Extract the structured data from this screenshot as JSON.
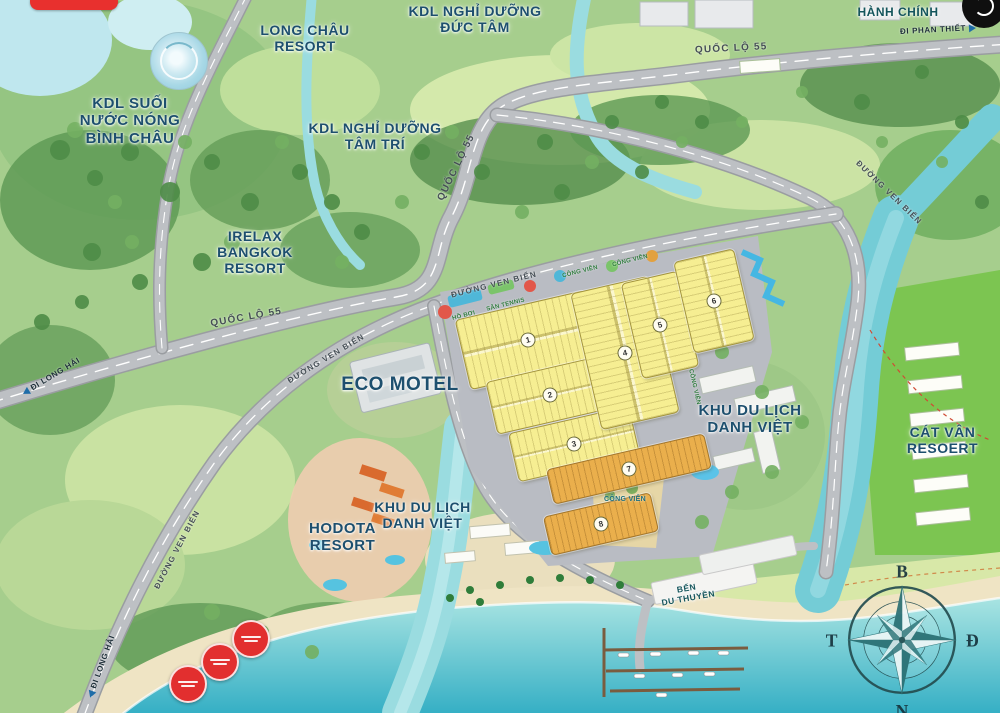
{
  "map": {
    "labels": {
      "binh_chau": "KDL SUỐI\nNƯỚC NÓNG\nBÌNH CHÂU",
      "long_chau": "LONG CHÂU\nRESORT",
      "duc_tam": "KDL NGHỈ DƯỠNG\nĐỨC TÂM",
      "tam_tri": "KDL NGHỈ DƯỠNG\nTÂM TRÍ",
      "irelax": "IRELAX\nBANGKOK\nRESORT",
      "hanh_chinh": "HÀNH CHÍNH",
      "eco_motel": "ECO MOTEL",
      "danh_viet": "KHU DU LỊCH\nDANH VIỆT",
      "cat_van": "CÁT VÂN\nRESOERT",
      "hodota": "HODOTA\nRESORT",
      "ben_du_thuyen": "BẾN\nDU THUYỀN"
    },
    "roads": {
      "quoc_lo_55": "QUỐC LỘ 55",
      "duong_ven_bien": "ĐƯỜNG VEN BIỂN"
    },
    "directions": {
      "di_phan_thiet": "ĐI PHAN THIẾT",
      "di_long_hai": "ĐI LONG HẢI"
    },
    "amenities": {
      "cong_vien": "CÔNG VIÊN",
      "ho_boi": "HỒ BƠI",
      "san_tennis": "SÂN TENNIS"
    },
    "compass": {
      "n": "B",
      "e": "Đ",
      "s": "N",
      "w": "T"
    },
    "blocks": {
      "b1": "1",
      "b2": "2",
      "b3": "3",
      "b4": "4",
      "b5": "5",
      "b6": "6",
      "b7": "7",
      "b8": "8"
    },
    "colors": {
      "label_blue": "#1d4f6e",
      "road_gray": "#bdc0c4",
      "lot_yellow": "#f6ee92",
      "lot_orange": "#eaaf4c",
      "sea_teal": "#33aec4",
      "badge_red": "#e22f2f"
    }
  }
}
